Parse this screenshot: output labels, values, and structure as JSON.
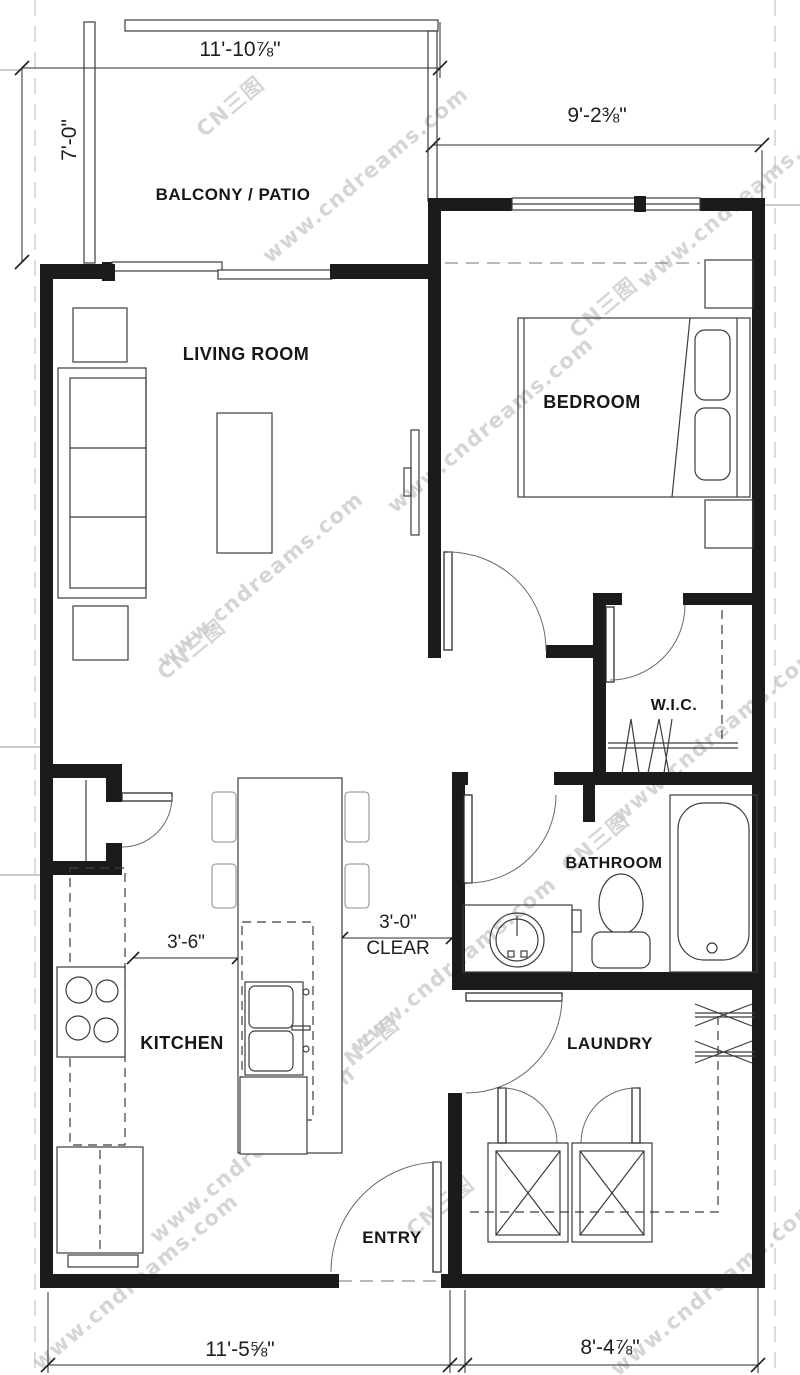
{
  "drawing": {
    "rooms": {
      "balcony": "BALCONY / PATIO",
      "living": "LIVING ROOM",
      "bedroom": "BEDROOM",
      "wic": "W.I.C.",
      "bathroom": "BATHROOM",
      "kitchen": "KITCHEN",
      "laundry": "LAUNDRY",
      "entry": "ENTRY"
    },
    "dimensions": {
      "balcony_width": "11'-10⅞\"",
      "balcony_depth": "7'-0\"",
      "bedroom_width": "9'-2⅜\"",
      "kitchen_aisle": "3'-6\"",
      "hall_clear_value": "3'-0\"",
      "hall_clear_word": "CLEAR",
      "overall_left": "11'-5⅝\"",
      "overall_right": "8'-4⅞\""
    },
    "watermark": {
      "url": "www.cndreams.com",
      "brand": "CN三图"
    },
    "colors": {
      "line": "#1b1b1b",
      "watermark": "#cbcbcb"
    }
  }
}
